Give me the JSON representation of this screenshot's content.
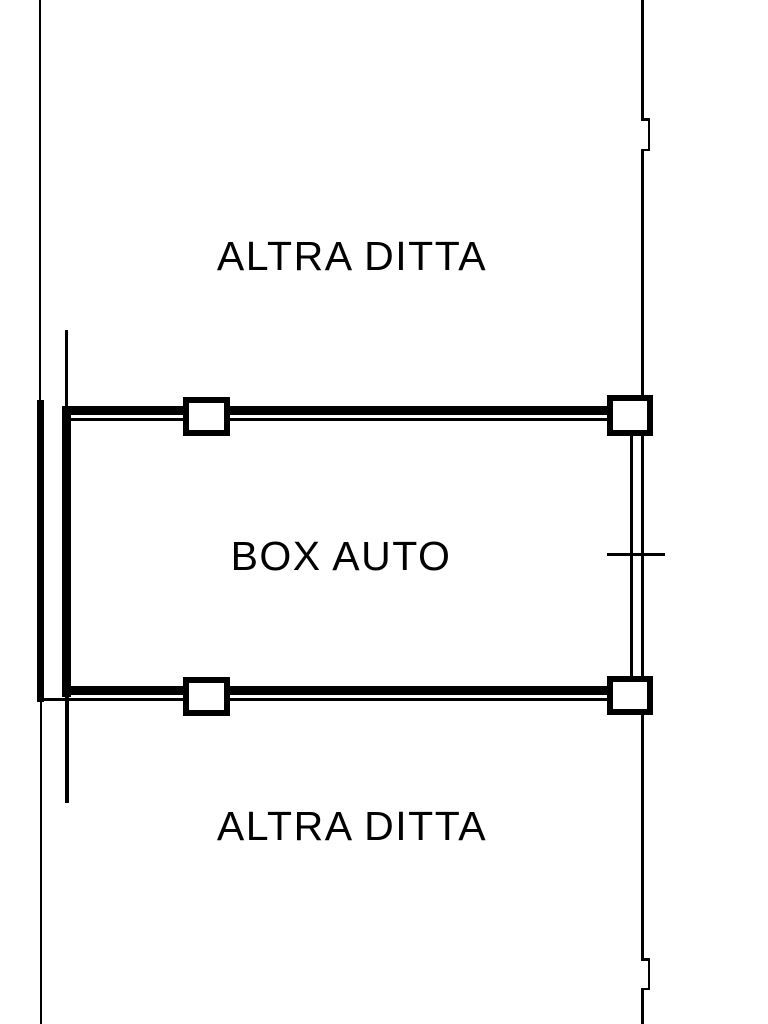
{
  "plan": {
    "type": "cadastral-floor-plan",
    "background_color": "#ffffff",
    "line_color": "#000000",
    "labels": {
      "adjacent_top": "ALTRA DITTA",
      "unit": "BOX AUTO",
      "adjacent_bottom": "ALTRA DITTA"
    }
  }
}
